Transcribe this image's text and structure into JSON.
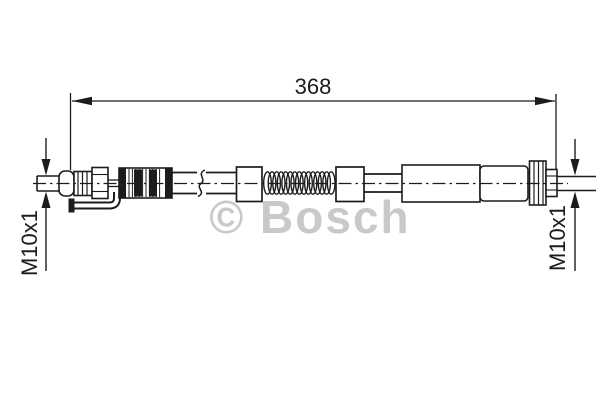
{
  "diagram": {
    "watermark": "© Bosch",
    "dimension_label": "368",
    "thread_label_left": "M10x1",
    "thread_label_right": "M10x1"
  },
  "colors": {
    "background": "#ffffff",
    "line": "#1c1c1c",
    "watermark": "#c9c9c9"
  }
}
